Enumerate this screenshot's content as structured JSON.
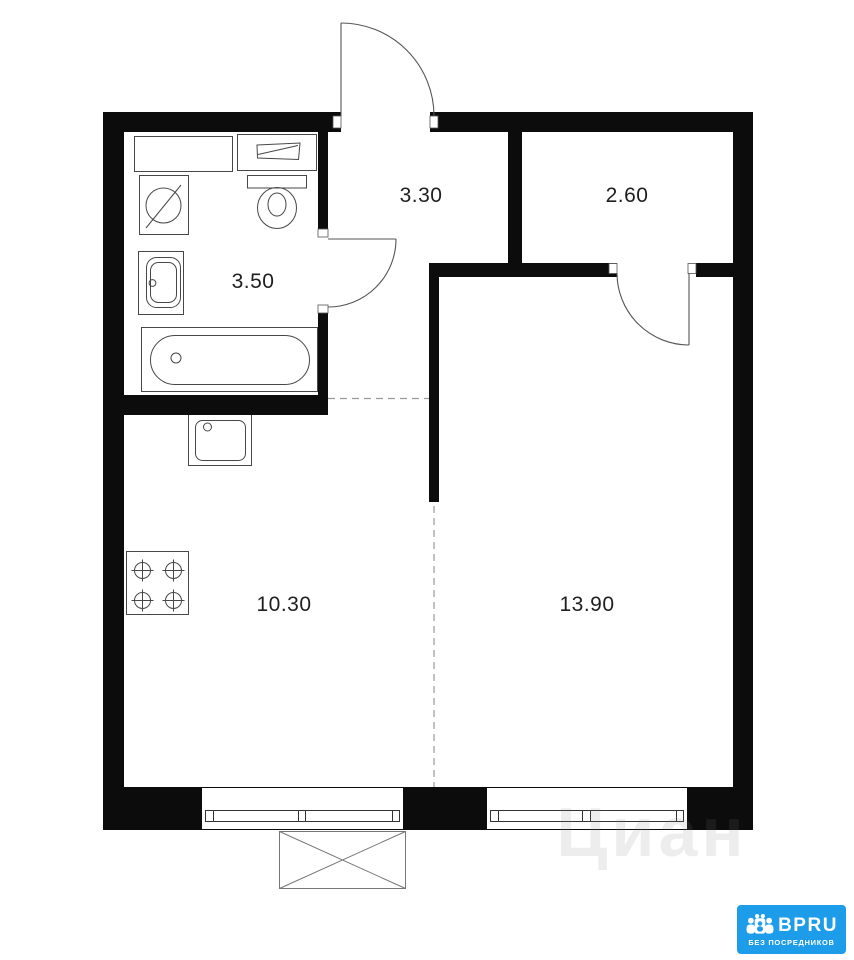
{
  "rooms": [
    {
      "name": "bathroom",
      "area": "3.50"
    },
    {
      "name": "hallway",
      "area": "3.30"
    },
    {
      "name": "wardrobe",
      "area": "2.60"
    },
    {
      "name": "kitchen",
      "area": "10.30"
    },
    {
      "name": "living-room",
      "area": "13.90"
    }
  ],
  "watermark": {
    "text": "Циан"
  },
  "logo": {
    "title": "BPRU",
    "subtitle": "БЕЗ ПОСРЕДНИКОВ",
    "background": "#1d9ce9",
    "text_color": "#ffffff"
  },
  "colors": {
    "wall": "#0c0c0c",
    "fixture_line": "#474747",
    "label_text": "#1f1f1f"
  }
}
